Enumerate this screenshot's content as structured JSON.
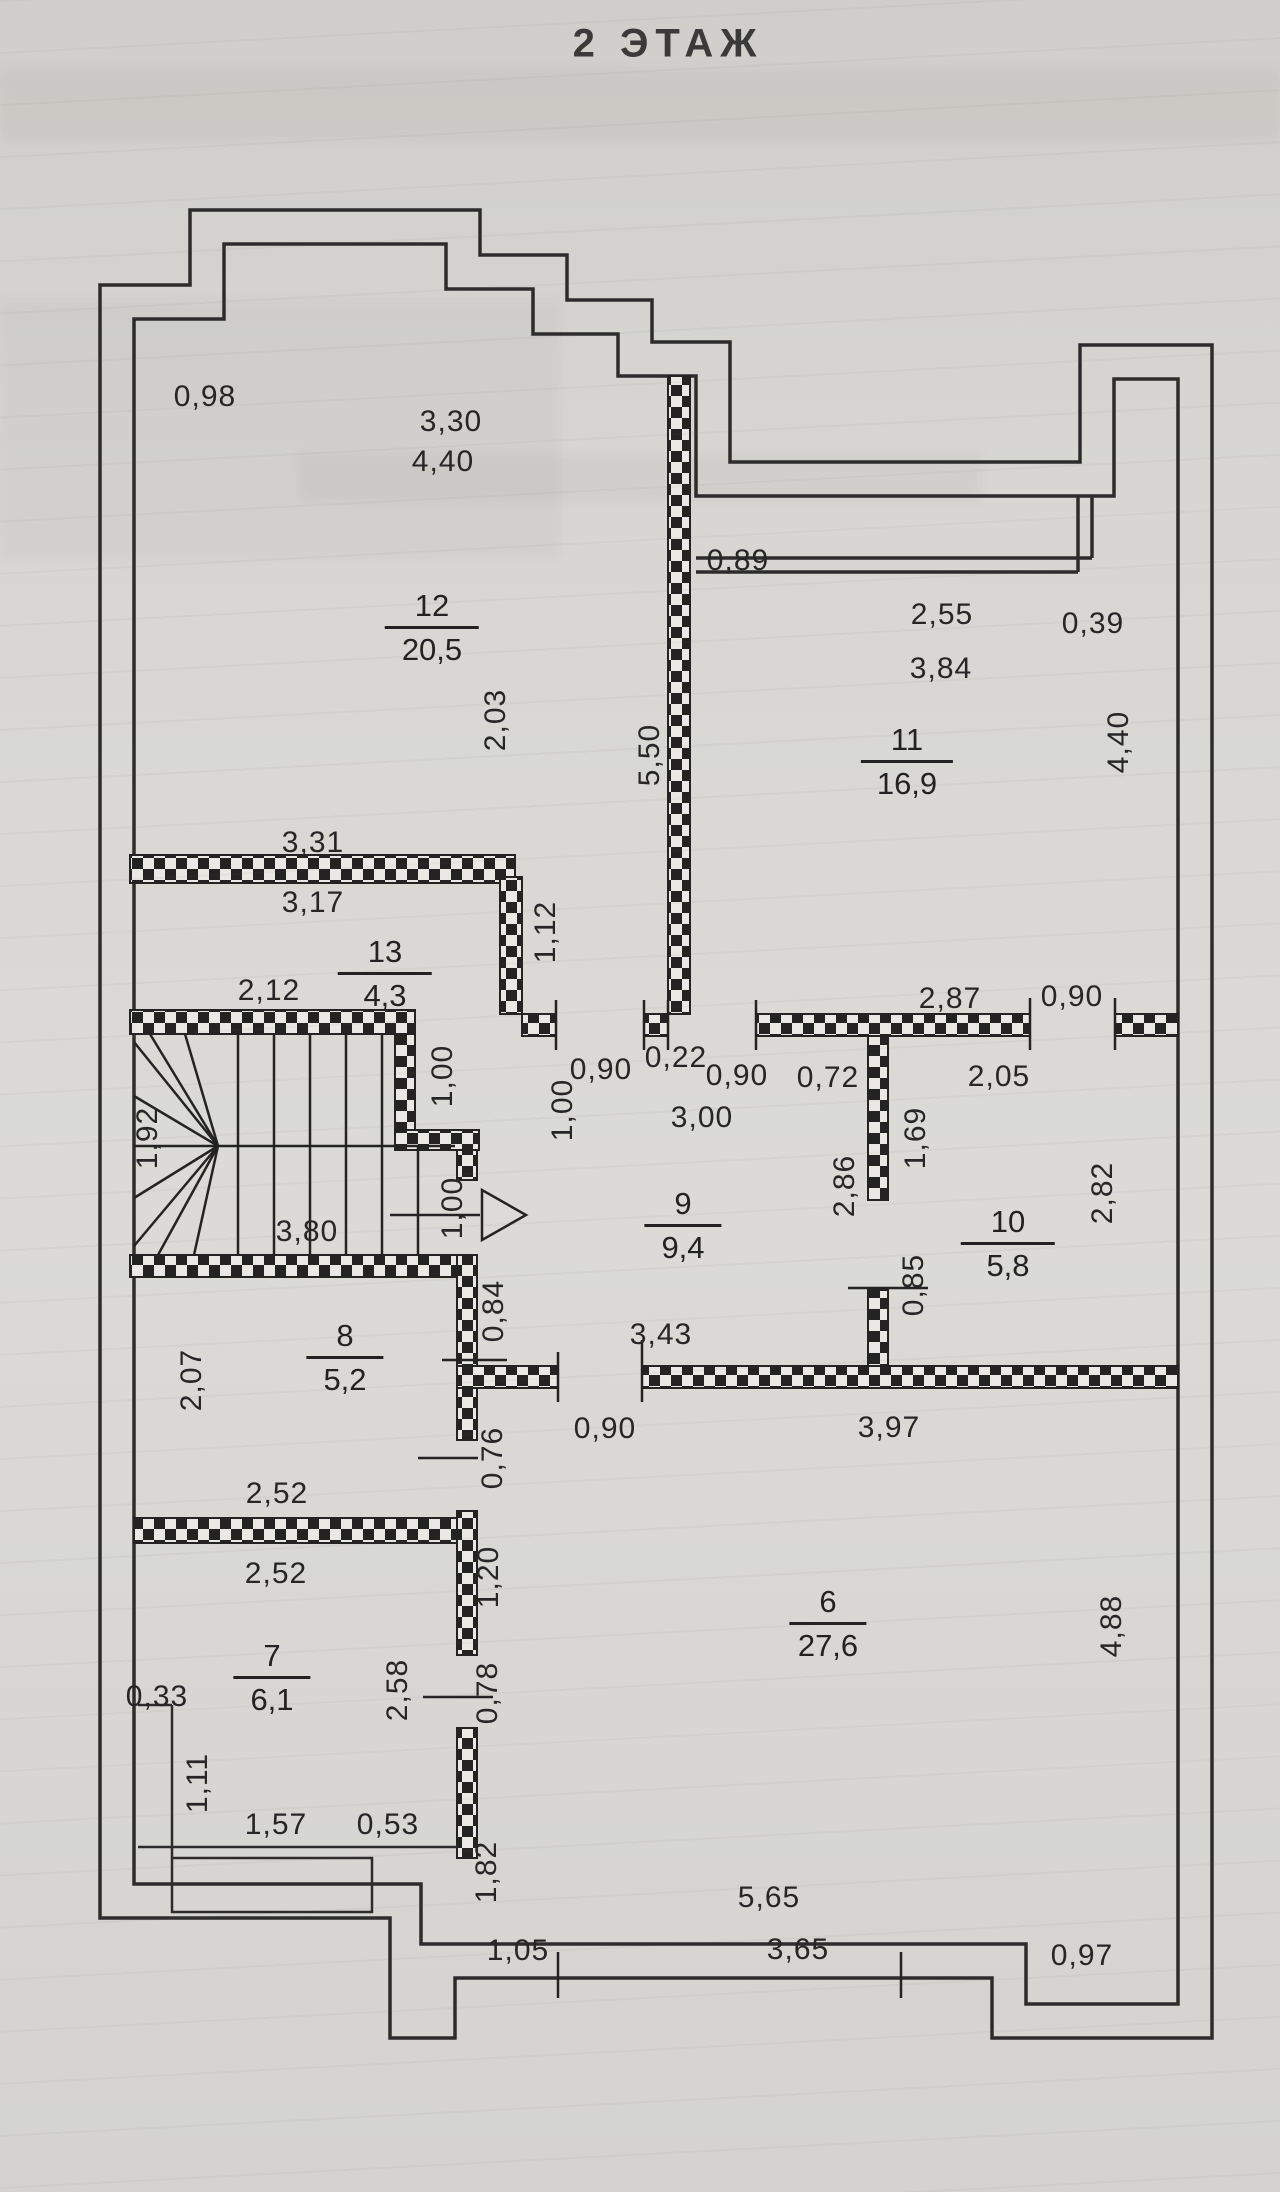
{
  "title": "2 ЭТАЖ",
  "paper_color": "#d6d5d1",
  "ink_color": "#262626",
  "rooms": [
    {
      "number": "12",
      "area": "20,5",
      "cx": 432,
      "top": 590
    },
    {
      "number": "11",
      "area": "16,9",
      "cx": 907,
      "top": 724
    },
    {
      "number": "13",
      "area": "4,3",
      "cx": 385,
      "top": 936
    },
    {
      "number": "9",
      "area": "9,4",
      "cx": 683,
      "top": 1188
    },
    {
      "number": "10",
      "area": "5,8",
      "cx": 1008,
      "top": 1206
    },
    {
      "number": "8",
      "area": "5,2",
      "cx": 345,
      "top": 1320
    },
    {
      "number": "7",
      "area": "6,1",
      "cx": 272,
      "top": 1640
    },
    {
      "number": "6",
      "area": "27,6",
      "cx": 828,
      "top": 1586
    }
  ],
  "dimensions": [
    {
      "t": "0,98",
      "x": 205,
      "y": 397,
      "v": false
    },
    {
      "t": "3,30",
      "x": 451,
      "y": 422,
      "v": false
    },
    {
      "t": "4,40",
      "x": 443,
      "y": 462,
      "v": false
    },
    {
      "t": "0,89",
      "x": 738,
      "y": 561,
      "v": false
    },
    {
      "t": "2,55",
      "x": 942,
      "y": 615,
      "v": false
    },
    {
      "t": "3,84",
      "x": 941,
      "y": 669,
      "v": false
    },
    {
      "t": "0,39",
      "x": 1093,
      "y": 624,
      "v": false
    },
    {
      "t": "5,50",
      "x": 650,
      "y": 755,
      "v": true
    },
    {
      "t": "4,40",
      "x": 1119,
      "y": 742,
      "v": true
    },
    {
      "t": "3,31",
      "x": 313,
      "y": 843,
      "v": false
    },
    {
      "t": "3,17",
      "x": 313,
      "y": 903,
      "v": false
    },
    {
      "t": "2,12",
      "x": 269,
      "y": 991,
      "v": false
    },
    {
      "t": "2,03",
      "x": 496,
      "y": 720,
      "v": true
    },
    {
      "t": "1,12",
      "x": 546,
      "y": 932,
      "v": true
    },
    {
      "t": "0,90",
      "x": 601,
      "y": 1070,
      "v": false
    },
    {
      "t": "0,22",
      "x": 676,
      "y": 1058,
      "v": false
    },
    {
      "t": "0,90",
      "x": 737,
      "y": 1076,
      "v": false
    },
    {
      "t": "3,00",
      "x": 702,
      "y": 1118,
      "v": false
    },
    {
      "t": "2,87",
      "x": 950,
      "y": 999,
      "v": false
    },
    {
      "t": "0,90",
      "x": 1072,
      "y": 997,
      "v": false
    },
    {
      "t": "0,72",
      "x": 828,
      "y": 1078,
      "v": false
    },
    {
      "t": "2,05",
      "x": 999,
      "y": 1077,
      "v": false
    },
    {
      "t": "1,69",
      "x": 916,
      "y": 1138,
      "v": true
    },
    {
      "t": "2,86",
      "x": 845,
      "y": 1186,
      "v": true
    },
    {
      "t": "0,85",
      "x": 914,
      "y": 1285,
      "v": true
    },
    {
      "t": "2,82",
      "x": 1103,
      "y": 1193,
      "v": true
    },
    {
      "t": "1,92",
      "x": 148,
      "y": 1138,
      "v": true
    },
    {
      "t": "1,00",
      "x": 443,
      "y": 1076,
      "v": true
    },
    {
      "t": "1,00",
      "x": 563,
      "y": 1110,
      "v": true
    },
    {
      "t": "1,00",
      "x": 453,
      "y": 1208,
      "v": true
    },
    {
      "t": "3,80",
      "x": 307,
      "y": 1232,
      "v": false
    },
    {
      "t": "0,84",
      "x": 494,
      "y": 1311,
      "v": true
    },
    {
      "t": "2,07",
      "x": 192,
      "y": 1380,
      "v": true
    },
    {
      "t": "2,52",
      "x": 277,
      "y": 1494,
      "v": false
    },
    {
      "t": "0,76",
      "x": 493,
      "y": 1458,
      "v": true
    },
    {
      "t": "3,43",
      "x": 661,
      "y": 1335,
      "v": false
    },
    {
      "t": "0,90",
      "x": 605,
      "y": 1429,
      "v": false
    },
    {
      "t": "3,97",
      "x": 889,
      "y": 1428,
      "v": false
    },
    {
      "t": "2,52",
      "x": 276,
      "y": 1574,
      "v": false
    },
    {
      "t": "0,33",
      "x": 157,
      "y": 1697,
      "v": false
    },
    {
      "t": "1,11",
      "x": 198,
      "y": 1783,
      "v": true
    },
    {
      "t": "2,58",
      "x": 398,
      "y": 1690,
      "v": true
    },
    {
      "t": "0,78",
      "x": 488,
      "y": 1693,
      "v": true
    },
    {
      "t": "1,20",
      "x": 489,
      "y": 1577,
      "v": true
    },
    {
      "t": "1,57",
      "x": 276,
      "y": 1825,
      "v": false
    },
    {
      "t": "0,53",
      "x": 388,
      "y": 1825,
      "v": false
    },
    {
      "t": "1,82",
      "x": 487,
      "y": 1872,
      "v": true
    },
    {
      "t": "4,88",
      "x": 1112,
      "y": 1626,
      "v": true
    },
    {
      "t": "1,05",
      "x": 518,
      "y": 1951,
      "v": false
    },
    {
      "t": "5,65",
      "x": 769,
      "y": 1898,
      "v": false
    },
    {
      "t": "3,65",
      "x": 798,
      "y": 1950,
      "v": false
    },
    {
      "t": "0,97",
      "x": 1082,
      "y": 1956,
      "v": false
    }
  ]
}
